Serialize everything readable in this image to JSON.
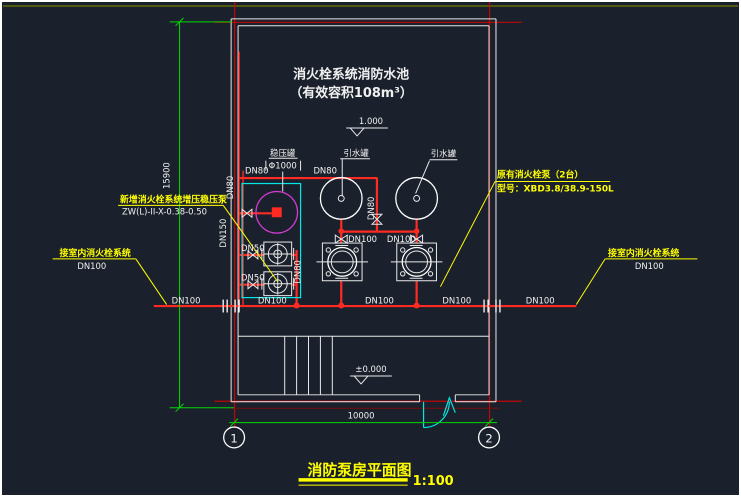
{
  "colors": {
    "background": "#1b212c",
    "line_white": "#f0f0f0",
    "pipe_red": "#ff2a21",
    "axis_red": "#c00606",
    "dim_green": "#00d800",
    "annotation_yellow": "#ffff00",
    "equipment_cyan": "#00e8e8",
    "tank_magenta": "#d43bd4"
  },
  "tank": {
    "title_line1": "消火栓系统消防水池",
    "title_line2": "（有效容积108m³）"
  },
  "levels": {
    "pool": "1.000",
    "floor": "±0.000"
  },
  "equipment": {
    "surge_tank_label": "稳压罐",
    "surge_tank_dia": "Φ1000",
    "priming_tank_1": "引水罐",
    "priming_tank_2": "引水罐"
  },
  "pipes": {
    "dn50": "DN50",
    "dn80": "DN80",
    "dn100": "DN100",
    "dn150": "DN150"
  },
  "annotations": {
    "new_pump": {
      "line1": "新增消火栓系统增压稳压泵",
      "line2": "ZW(L)-II-X-0.38-0.50"
    },
    "existing_pump": {
      "line1": "原有消火栓泵（2台）",
      "line2": "型号：XBD3.8/38.9-150L"
    },
    "left_system": {
      "label": "接室内消火栓系统",
      "size": "DN100"
    },
    "right_system": {
      "label": "接室内消火栓系统",
      "size": "DN100"
    }
  },
  "dimensions": {
    "width": "10000",
    "height": "15900"
  },
  "axes": {
    "grid_1": "1",
    "grid_2": "2"
  },
  "title_block": {
    "title": "消防泵房平面图",
    "scale": "1:100"
  }
}
